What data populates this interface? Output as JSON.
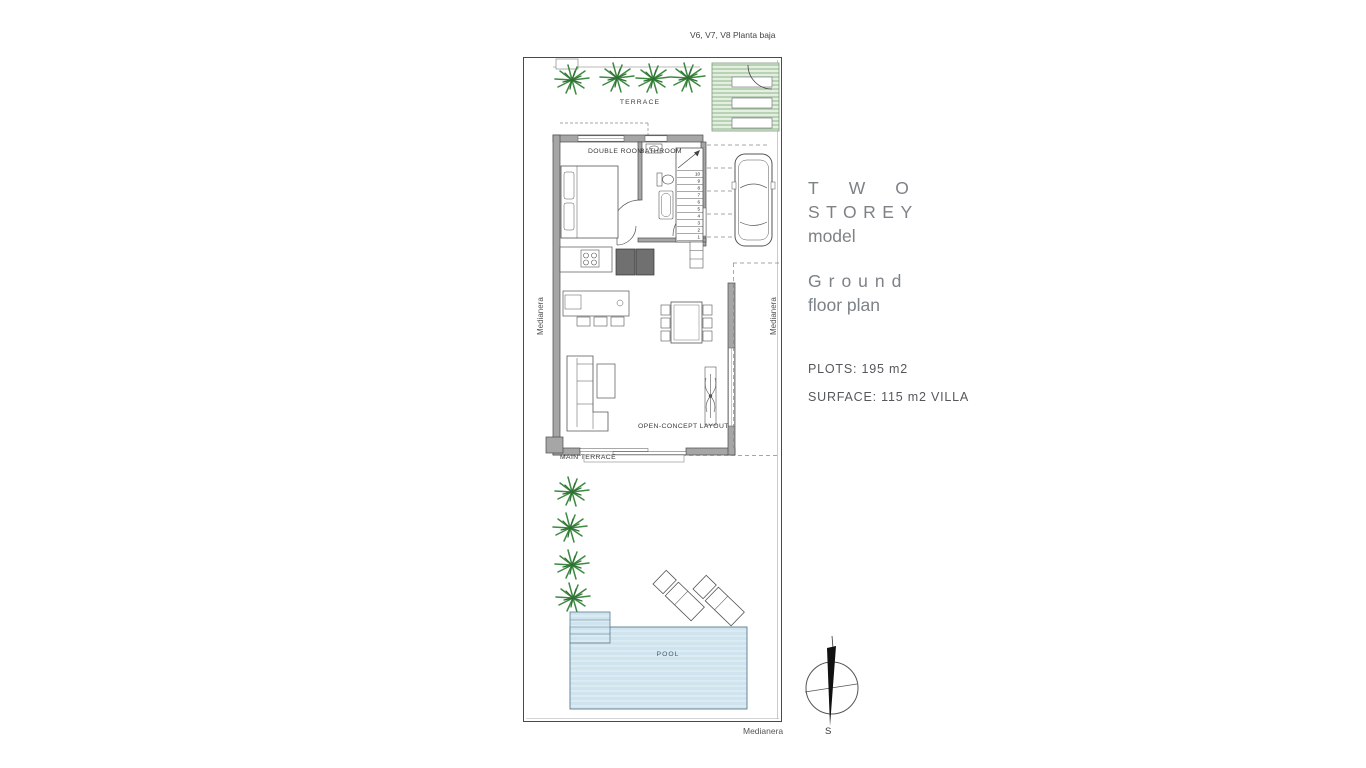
{
  "plan": {
    "header": "V6, V7, V8 Planta baja",
    "labels": {
      "terrace": "TERRACE",
      "double_room": "DOUBLE ROOM",
      "bathroom": "BATHROOM",
      "open_concept": "OPEN-CONCEPT LAYOUT",
      "main_terrace": "MAIN TERRACE",
      "pool": "POOL"
    },
    "boundary_labels": {
      "left": "Medianera",
      "right": "Medianera",
      "bottom": "Medianera"
    },
    "stairs": {
      "numbers": [
        "1",
        "2",
        "3",
        "4",
        "5",
        "6",
        "7",
        "8",
        "9",
        "10"
      ]
    },
    "compass": {
      "south": "S"
    }
  },
  "info_panel": {
    "model": {
      "line1": "TWO",
      "line2": "STOREY",
      "line3": "model"
    },
    "plan_name": {
      "line1": "Ground",
      "line2": "floor plan"
    },
    "plots": "PLOTS: 195 m2",
    "surface": "SURFACE: 115 m2 VILLA"
  },
  "colors": {
    "wall": "#a6a6a6",
    "pool_water": "#cfe4ee",
    "grass": "#e3efdf",
    "plant_green": "#3c8a41",
    "heading_text": "#7d8286",
    "info_text": "#54585c",
    "line": "#4a4a4a"
  }
}
